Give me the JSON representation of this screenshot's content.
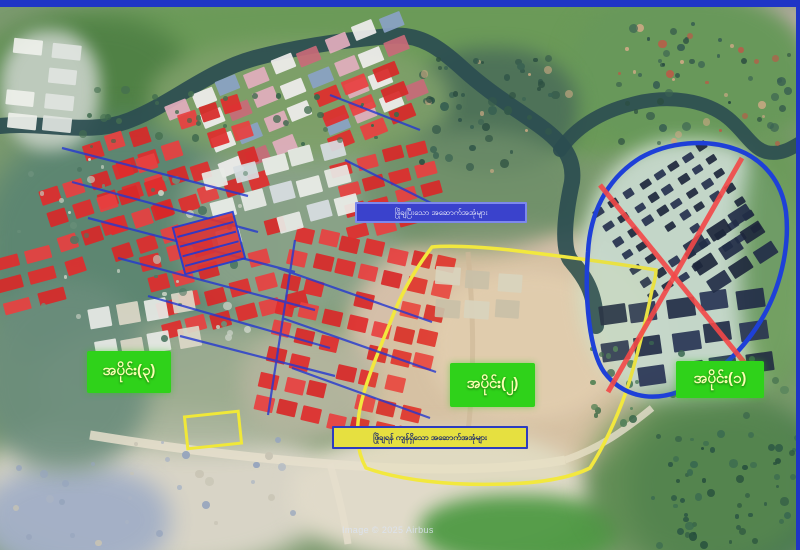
{
  "map": {
    "section_labels": [
      {
        "name": "section-1",
        "text": "အပိုင်း(၁)"
      },
      {
        "name": "section-2",
        "text": "အပိုင်း(၂)"
      },
      {
        "name": "section-3",
        "text": "အပိုင်း(၃)"
      }
    ],
    "banners": {
      "top": {
        "text": "ဖြိုချပြီးသော အဆောက်အအုံများ"
      },
      "bottom": {
        "text": "ဖြိုချရန် ကျန်ရှိသော အဆောက်အအုံများ"
      }
    },
    "watermark": "Image © 2025 Airbus",
    "legend_colors": {
      "demolished_building_mark": "#e02c2c",
      "hatch_line": "#2438d0",
      "section1_boundary": "#1e40d8",
      "section1_cross": "#f34848",
      "section2_boundary": "#f2e83e",
      "section_label_background": "#2fd21a",
      "top_banner_background": "#3a42cc",
      "bottom_banner_background": "#e6e040"
    }
  }
}
